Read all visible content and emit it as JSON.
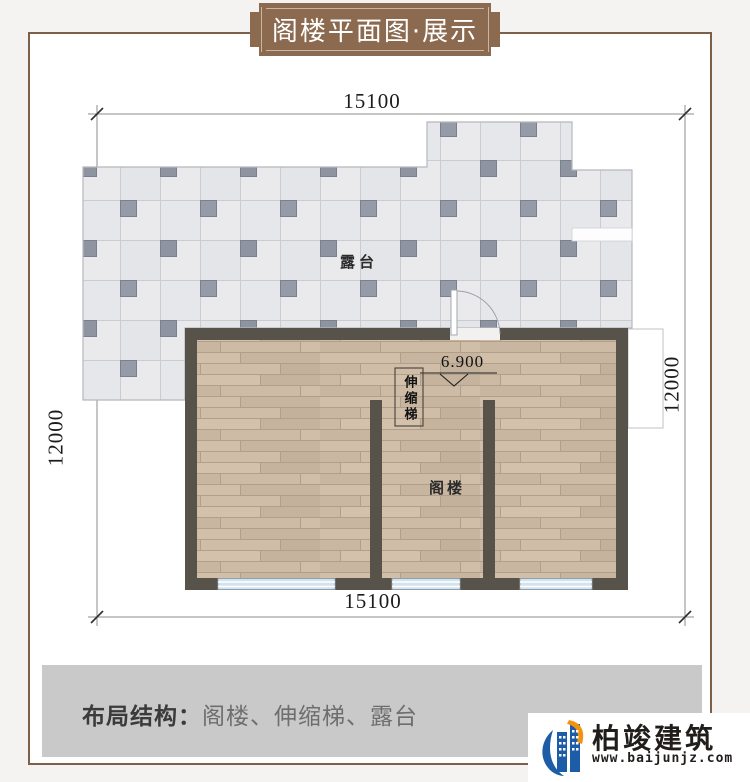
{
  "banner": {
    "title": "阁楼平面图·展示"
  },
  "plan": {
    "dimensions": {
      "top": "15100",
      "bottom": "15100",
      "left": "12000",
      "right": "12000"
    },
    "labels": {
      "terrace": "露台",
      "attic": "阁楼",
      "ladder": "伸缩梯",
      "elevation": "6.900"
    }
  },
  "footer": {
    "label": "布局结构：",
    "value": "阁楼、伸缩梯、露台"
  },
  "logo": {
    "name": "柏竣建筑",
    "site": "www.baijunjz.com"
  },
  "colors": {
    "accent_brown": "#8b6a50",
    "frame_border": "#7e5f47",
    "wall": "#57524a",
    "wood_floor": "#ccbaa5",
    "tile_light": "#eaeaec",
    "tile_dark": "#8e94a0",
    "window_glass": "#d3e2ec",
    "footer_bar": "#c9c9c9",
    "logo_blue": "#1d5ca6",
    "logo_orange": "#f2920f"
  }
}
